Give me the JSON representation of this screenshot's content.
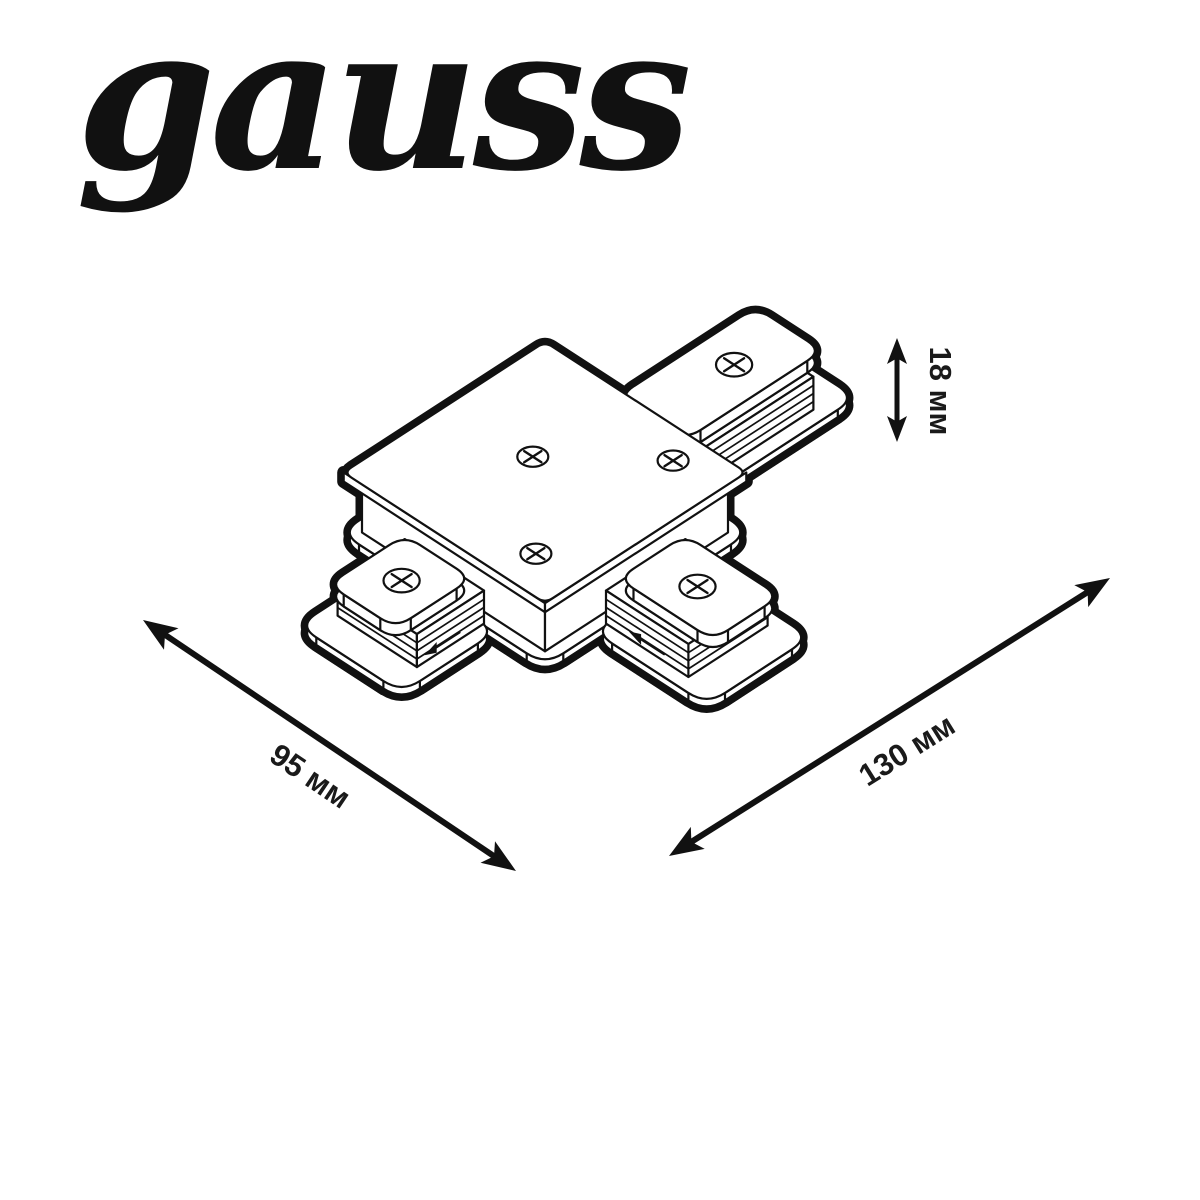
{
  "page": {
    "background": "#ffffff",
    "line_color": "#111111"
  },
  "brand": {
    "logo_text": "gauss"
  },
  "diagram": {
    "subject": "T-shaped track connector, isometric technical drawing",
    "screws_visible": 6,
    "dimensions": {
      "height": {
        "label": "18 мм"
      },
      "width": {
        "label": "95 мм"
      },
      "length": {
        "label": "130 мм"
      }
    }
  }
}
